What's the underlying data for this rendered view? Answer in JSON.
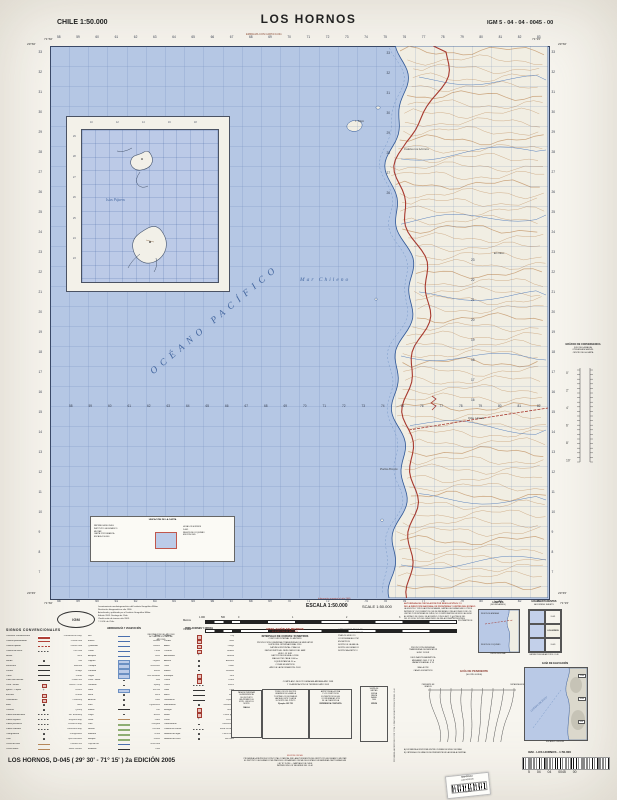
{
  "header": {
    "country_scale": "CHILE 1:50.000",
    "title": "LOS HORNOS",
    "sheet_code": "IGM 5 - 04 - 04 - 0045 - 00",
    "edge_note": "EMPALMA CON CARTA D-041"
  },
  "map": {
    "ocean_label": "OCÉANO PACÍFICO",
    "sea_label": "Mar Chileno",
    "inset_island_label": "Islas Pájaros",
    "place_labels": [
      {
        "t": "I. Tilgo",
        "x": 355,
        "y": 119
      },
      {
        "t": "Caleta Los Hornos",
        "x": 404,
        "y": 147
      },
      {
        "t": "Qda. Honda",
        "x": 468,
        "y": 416
      },
      {
        "t": "Punta Poroto",
        "x": 380,
        "y": 467
      },
      {
        "t": "El Olivo",
        "x": 494,
        "y": 251
      }
    ],
    "corner_coords": {
      "tl_lat": "29°30'",
      "tl_lon": "71°30'",
      "tr_lat": "29°30'",
      "tr_lon": "71°15'",
      "bl_lat": "29°45'",
      "bl_lon": "71°30'",
      "br_lat": "29°45'",
      "br_lon": "71°15'"
    },
    "grid": {
      "eastings": [
        "58",
        "59",
        "60",
        "61",
        "62",
        "63",
        "64",
        "65",
        "66",
        "67",
        "68",
        "69",
        "70",
        "71",
        "72",
        "73",
        "74",
        "75",
        "76",
        "77",
        "78",
        "79",
        "80",
        "81",
        "82",
        "83"
      ],
      "northings": [
        "33",
        "32",
        "31",
        "30",
        "29",
        "28",
        "27",
        "26",
        "25",
        "24",
        "23",
        "22",
        "21",
        "20",
        "19",
        "18",
        "17",
        "16",
        "15",
        "14",
        "13",
        "12",
        "11",
        "10",
        "9",
        "8",
        "7"
      ],
      "water_row": [
        "58",
        "59",
        "60",
        "61",
        "62",
        "63",
        "64",
        "65",
        "66",
        "67",
        "68",
        "69",
        "70",
        "71",
        "72",
        "73",
        "74",
        "75",
        "76",
        "77",
        "78",
        "79",
        "80",
        "81",
        "82"
      ],
      "coast_col": [
        "23",
        "22",
        "21",
        "20",
        "19",
        "18",
        "17",
        "16"
      ],
      "land_col": [
        "33",
        "32",
        "31",
        "30",
        "29",
        "28",
        "27",
        "26"
      ],
      "inset_left": [
        "29",
        "28",
        "27",
        "26",
        "25",
        "24",
        "23"
      ],
      "inset_top": [
        "10",
        "12",
        "14",
        "16",
        "18"
      ]
    },
    "info_box": {
      "title": "UBICACIÓN DE LA CARTA",
      "left_lines": [
        "REPÚBLICA DE CHILE",
        "INSTITUTO GEOGRÁFICO",
        "MILITAR",
        "CARTA TOPOGRÁFICA",
        "ESCALA 1:50.000"
      ],
      "right_lines": [
        "HOJA LOS HORNOS",
        "D-045",
        "REGIÓN DE COQUIMBO",
        "EDICIÓN 2005"
      ]
    }
  },
  "right_margin": {
    "convergence_lines": [
      "GRÁFICO DE CONVERGENCIA",
      "(USO DE LA MALLA)",
      "CONVERGENCIA EN EL",
      "CENTRO DE LA CARTA"
    ],
    "convergence_ticks": [
      "0'",
      "2'",
      "4'",
      "6'",
      "8'",
      "10'"
    ]
  },
  "scale_block": {
    "escala": "ESCALA 1:50.000",
    "scale_en": "SCALE 1:50.000",
    "red_note": "Información marginal al año 2005",
    "metros": "Metros",
    "yardas": "Yardas",
    "kilometros": "KILÓMETROS",
    "ticks": [
      "1.000",
      "500",
      "0",
      "1",
      "2",
      "3",
      "4"
    ]
  },
  "publisher": {
    "logo": "IGM",
    "lines": [
      "Levantamiento aerofotogramétrico del Instituto Geográfico Militar.",
      "Restitución fotogramétrica año 1966.",
      "Actualizado y publicado por el Instituto Geográfico Militar.",
      "Edición 2005. Santiago de Chile.",
      "Clasificación de terreno año 2003.",
      "© I.G.M. de Chile."
    ],
    "info_lines": [
      "INFORMACIÓN DEL AÑO 2003",
      "ACTUALIZACIÓN PARCIAL",
      "AÑO 2005"
    ]
  },
  "difrol": {
    "red_lines": [
      "AUTORIZADA SU CIRCULACIÓN POR RESOLUCIÓN N° 13",
      "DE LA DIRECCIÓN NACIONAL DE FRONTERAS Y LÍMITES DEL ESTADO"
    ],
    "black_lines": [
      "LA EDICIÓN Y CIRCULACIÓN DE MAPAS, CARTAS GEOGRÁFICAS U OTROS",
      "IMPRESOS Y DOCUMENTOS QUE SE REFIERAN O RELACIONEN CON LOS",
      "LÍMITES Y FRONTERAS DE CHILE, NO COMPROMETEN EN MODO ALGUNO",
      "AL ESTADO DE CHILE, DE ACUERDO CON EL ART. 2°, LETRA G) DEL",
      "DFL N° 83 DE 1979 DEL MINISTERIO DE RELACIONES EXTERIORES"
    ]
  },
  "limites": {
    "title": "LÍMITES",
    "subtitle": "(BOUNDARIES)",
    "label_top": "REGIÓN DE ATACAMA",
    "label_bottom": "REGIÓN DE COQUIMBO",
    "caption": "LÍMITE REGIONAL"
  },
  "adjacent": {
    "title": "HOJAS ADYACENTES",
    "subtitle": "ADJOINING SHEETS",
    "cells": [
      "",
      "D-041",
      "",
      "LOS HORNOS",
      "",
      "D-049"
    ],
    "caption": "CARTAS PUBLICADAS POR EL I.G.M."
  },
  "declination": {
    "blocks": [
      [
        "PROYECCIÓN UNIVERSAL",
        "TRANSVERSAL DE MERCATOR",
        "HUSO 19 SUR"
      ],
      [
        "DECLINACIÓN MAGNÉTICA",
        "MEDIA AÑO 2005: 2°15' E",
        "VARIACIÓN ANUAL: 8' W"
      ],
      [
        "MALLA UTM",
        "CADA 1.000 METROS"
      ]
    ],
    "vertical_note": "PROHIBIDA LA REPRODUCCIÓN TOTAL O PARCIAL SIN AUTORIZACIÓN DEL I.G.M."
  },
  "legend": {
    "title": "SIGNOS CONVENCIONALES",
    "col1_header": "CAMINOS Y VÍAS",
    "col2_header": "HIDROGRAFÍA Y VEGETACIÓN",
    "col3_header": "POBLACIONES Y OBRAS",
    "col1": [
      [
        "Carretera Panamericana",
        "Panamerican Hwy.",
        "red2"
      ],
      [
        "Camino pavimentado",
        "Paved road",
        "red"
      ],
      [
        "Camino ripiado",
        "Gravel road",
        "redd"
      ],
      [
        "Camino de tierra",
        "Dirt road",
        "dsh"
      ],
      [
        "Huella",
        "Track",
        "dsh"
      ],
      [
        "Senda",
        "Trail",
        "dot"
      ],
      [
        "Ferrocarril",
        "Railroad",
        "blk"
      ],
      [
        "Puente",
        "Bridge",
        "blk"
      ],
      [
        "Túnel",
        "Tunnel",
        "blk"
      ],
      [
        "Línea alta tensión",
        "Power line",
        "blk"
      ],
      [
        "Casa - Ruina",
        "House - Ruin",
        "sq"
      ],
      [
        "Iglesia - Capilla",
        "Church",
        "cross"
      ],
      [
        "Escuela",
        "School",
        "sq"
      ],
      [
        "Cementerio",
        "Cemetery",
        "sq"
      ],
      [
        "Mina",
        "Mine",
        "dot"
      ],
      [
        "Cantera",
        "Quarry",
        "dot"
      ],
      [
        "Límite internacional",
        "Intl. boundary",
        "dsh"
      ],
      [
        "Límite regional",
        "Regional bdy.",
        "dsh"
      ],
      [
        "Límite provincial",
        "Provincial bdy.",
        "dsh"
      ],
      [
        "Límite comunal",
        "Communal bdy.",
        "dsh"
      ],
      [
        "Triangulación",
        "Triangulation",
        "dot"
      ],
      [
        "Cota",
        "Spot elevation",
        "dot"
      ],
      [
        "Curva de nivel",
        "Contour line",
        "brn"
      ],
      [
        "Curva índice",
        "Index contour",
        "brn"
      ]
    ],
    "col2": [
      [
        "Río",
        "River",
        "blu"
      ],
      [
        "Estero",
        "Stream",
        "blu"
      ],
      [
        "Quebrada",
        "Ravine",
        "blu"
      ],
      [
        "Canal",
        "Canal",
        "blu"
      ],
      [
        "Acequia",
        "Ditch",
        "blu"
      ],
      [
        "Laguna",
        "Lagoon",
        "blua"
      ],
      [
        "Tranque",
        "Reservoir",
        "blua"
      ],
      [
        "Pantano",
        "Marsh",
        "blua"
      ],
      [
        "Vegas",
        "Wet meadow",
        "blua"
      ],
      [
        "Pozo - Noria",
        "Well",
        "dot"
      ],
      [
        "Vertiente",
        "Spring",
        "dot"
      ],
      [
        "Salar",
        "Salt flat",
        "blua"
      ],
      [
        "Roca",
        "Rock",
        "dot"
      ],
      [
        "Arrecife",
        "Reef",
        "dot"
      ],
      [
        "Faro",
        "Lighthouse",
        "dot"
      ],
      [
        "Muelle",
        "Pier",
        "blk"
      ],
      [
        "Playa",
        "Beach",
        "dot"
      ],
      [
        "Duna",
        "Dune",
        "brn"
      ],
      [
        "Viña",
        "Vineyard",
        "grn"
      ],
      [
        "Huerto",
        "Orchard",
        "grn"
      ],
      [
        "Matorral",
        "Scrub",
        "grn"
      ],
      [
        "Bosque",
        "Forest",
        "grn"
      ],
      [
        "Caja de río",
        "River bed",
        "blu"
      ],
      [
        "Embalse",
        "Dam",
        "blk"
      ]
    ],
    "col3": [
      [
        "Ciudad",
        "City",
        "sq"
      ],
      [
        "Pueblo",
        "Town",
        "sq"
      ],
      [
        "Aldea",
        "Village",
        "sq"
      ],
      [
        "Caserío",
        "Hamlet",
        "sq"
      ],
      [
        "Aeródromo",
        "Airfield",
        "cross"
      ],
      [
        "Antena",
        "Antenna",
        "dot"
      ],
      [
        "Torre",
        "Tower",
        "dot"
      ],
      [
        "Molino",
        "Windmill",
        "dot"
      ],
      [
        "Estanque",
        "Tank",
        "sq"
      ],
      [
        "Corral",
        "Corral",
        "sq"
      ],
      [
        "Cerco",
        "Fence",
        "dsh"
      ],
      [
        "Vado",
        "Ford",
        "blk"
      ],
      [
        "Balsa",
        "Ferry",
        "blk"
      ],
      [
        "Gasoducto",
        "Pipeline",
        "blk"
      ],
      [
        "Monumento",
        "Monument",
        "dot"
      ],
      [
        "Refugio",
        "Shelter",
        "sq"
      ],
      [
        "Retén",
        "Police post",
        "sq"
      ],
      [
        "Posta",
        "First aid",
        "cross"
      ],
      [
        "Observatorio",
        "Observatory",
        "dot"
      ],
      [
        "Camino en constr.",
        "Road u/constr.",
        "dsh"
      ],
      [
        "Nombre de lugar",
        "Place name",
        "dot"
      ],
      [
        "Nombre de cerro",
        "Hill name",
        "dot"
      ]
    ]
  },
  "elevation": {
    "title_es": "NIVELACIÓN EN METROS",
    "title_en": "ELEVATIONS IN METERS",
    "interval_es": "INTERVALO DE CURVAS: 50 METROS",
    "interval_en": "CONTOUR INTERVAL 50 METERS",
    "lines": [
      "PROYECCIÓN: UNIVERSAL TRANSVERSAL DE MERCATOR",
      "ELIPSOIDE: INTERNACIONAL 1924",
      "DATUM HORIZONTAL: PSAD-56",
      "DATUM VERTICAL: NIVEL MEDIO DEL MAR",
      "HUSO: 19 SUR",
      "FACTOR DE ESCALA: 0.9996",
      "MALLA UTM: CADA 1.000 m",
      "EQUIDISTANCIA: 50 m",
      "COTAS EN METROS",
      "AÑO DE LA INFORMACIÓN: 2003"
    ],
    "note_lines": [
      "COMPILADO DE FOTOGRAFÍAS AÉREAS AÑO 1998",
      "Y CLASIFICACIÓN DE TERRENO AÑO 2003"
    ],
    "right_lines": [
      "CARTOGRAFÍA REGULAR",
      "SISTEMA DE REFERENCIA",
      "PSAD-56 HUSO 19",
      "COORDENADAS UTM",
      "EN METROS",
      "NORTE DE LA MALLA",
      "NORTE GEOGRÁFICO",
      "NORTE MAGNÉTICO"
    ]
  },
  "note_boxes": [
    {
      "caption": "MALLA",
      "lines": [
        "PARA DETERMINAR",
        "LA REFERENCIA",
        "DE UN PUNTO",
        "LEA PRIMERO EL",
        "ESTE, LUEGO EL",
        "NORTE"
      ]
    },
    {
      "caption": "Ejemplo: 283 725",
      "lines": [
        "TOME LOS DOS DÍGITOS",
        "GRANDES DE LA MALLA",
        "Y ESTIME LOS DECIMALES",
        "HACIA EL ESTE Y HACIA",
        "EL NORTE DEL PUNTO"
      ]
    },
    {
      "caption": "REFERENCIA COMPLETA",
      "lines": [
        "ANTEPONGA LA ZONA",
        "Y LOS CIENTOS DE",
        "KILÓMETROS DE LAS",
        "COORDENADAS UTM",
        "DE LA CUADRÍCULA"
      ]
    },
    {
      "caption": "VENTA",
      "lines": [
        "VENTA DE",
        "CARTAS:",
        "NUEVA",
        "SANTA",
        "ISABEL",
        "1640"
      ]
    }
  ],
  "pendiente": {
    "title": "GUÍA DE PENDIENTE",
    "subtitle": "(SLOPE GUIDE)",
    "left_label": "PENDIENTE EN GRADOS",
    "right_label": "DISTANCIA EN METROS",
    "captions": [
      "A) DISTANCIA HORIZONTAL ENTRE CURVAS DE NIVEL VECINAS",
      "B) OBTENGA LOS GRADOS DE PENDIENTE EN LA ESCALA CENTRAL"
    ]
  },
  "elev_guide": {
    "title": "GUÍA DE ELEVACIÓN",
    "tags": [
      "1500",
      "1000",
      "500"
    ],
    "ocean": "OCÉANO PACÍFICO",
    "caption": "ESCALA 1:1.000.000"
  },
  "footer": {
    "title": "LOS HORNOS, D-045 ( 29° 30' - 71° 15' ) 2a EDICIÓN 2005",
    "copyright_lines": [
      "EDICIÓN OFICIAL",
      "PROHIBIDA LA REPRODUCCIÓN TOTAL O PARCIAL SIN LA AUTORIZACIÓN DEL INSTITUTO GEOGRÁFICO MILITAR",
      "EL INSTITUTO GEOGRÁFICO MILITAR ES EL ORGANISMO OFICIAL DEL ESTADO EN MATERIAS CARTOGRÁFICAS",
      "LEY N° 15.284 — SANTIAGO DE CHILE",
      "IMPRESO EN LOS TALLERES DEL I.G.M."
    ],
    "igm_line": "IGM - LOS HORNOS - 1:50.000",
    "barcode_digits": "5 04 04 0045 00",
    "sticker_line1": "MAPOTECA",
    "sticker_line2": "LOS HORNOS",
    "sticker_num": "027037"
  }
}
